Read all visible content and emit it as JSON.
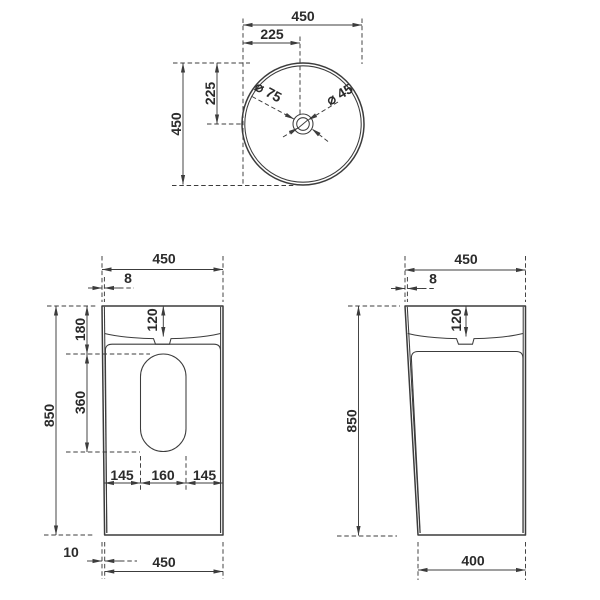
{
  "drawing": {
    "product": "freestanding-basin-dimension-drawing",
    "colors": {
      "line": "#3c3c3c",
      "text": "#2b2b2b",
      "background": "#ffffff"
    },
    "views": {
      "top": {
        "dim_width": "450",
        "dim_center_x": "225",
        "dim_height": "450",
        "dim_center_y": "225",
        "dim_drain_outer": "⌀ 75",
        "dim_drain_inner": "⌀ 45"
      },
      "front": {
        "dim_width_top": "450",
        "dim_wall": "8",
        "dim_basin_depth": "120",
        "dim_rim_to_cutout": "180",
        "dim_cutout_height": "360",
        "dim_height": "850",
        "dim_cutout_left": "145",
        "dim_cutout_width": "160",
        "dim_cutout_right": "145",
        "dim_base_inset": "10",
        "dim_width_bottom": "450"
      },
      "side": {
        "dim_width_top": "450",
        "dim_wall": "8",
        "dim_basin_depth": "120",
        "dim_height": "850",
        "dim_width_bottom": "400"
      }
    }
  }
}
